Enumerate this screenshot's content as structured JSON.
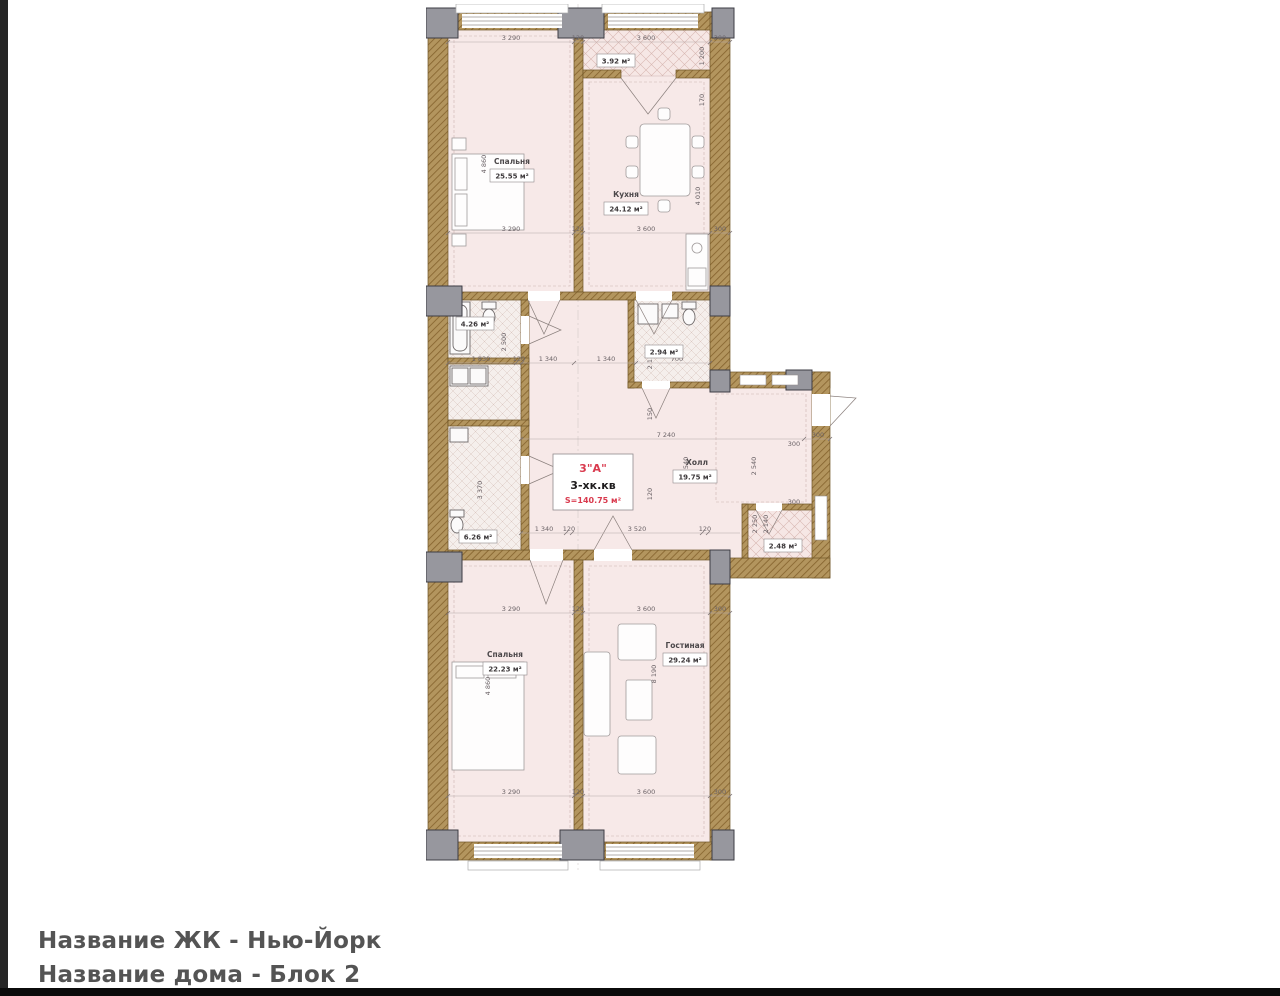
{
  "page": {
    "background": "#ffffff",
    "left_strip_color": "#262626",
    "bottom_strip_color": "#0b0b0b"
  },
  "footer": {
    "line1": "Название ЖК - Нью-Йорк",
    "line2": "Название дома - Блок 2"
  },
  "plan": {
    "apartment": {
      "number": "3\"А\"",
      "type": "3-хк.кв",
      "total_area": "S=140.75 м²"
    },
    "rooms": {
      "bedroom_top": {
        "name": "Спальня",
        "area": "25.55 м²"
      },
      "kitchen": {
        "name": "Кухня",
        "area": "24.12 м²"
      },
      "loggia_top": {
        "area": "3.92 м²"
      },
      "bathroom_1": {
        "area": "4.26 м²"
      },
      "wc": {
        "area": "2.94 м²"
      },
      "hall": {
        "name": "Холл",
        "area": "19.75 м²"
      },
      "bathroom_2": {
        "area": "6.26 м²"
      },
      "loggia_right": {
        "area": "2.48 м²"
      },
      "bedroom_bottom": {
        "name": "Спальня",
        "area": "22.23 м²"
      },
      "living_room": {
        "name": "Гостиная",
        "area": "29.24 м²"
      }
    },
    "dims": {
      "h_top": [
        "3 290",
        "120",
        "3 600",
        "300"
      ],
      "h_mid1": [
        "1 830",
        "120",
        "1 340",
        "1 340",
        "700"
      ],
      "h_hall": [
        "7 240",
        "300"
      ],
      "h_mid2": [
        "1 340",
        "120",
        "3 520",
        "120"
      ],
      "v": {
        "bedroom_top": "4 860",
        "loggia_top_depth": "1 200",
        "loggia_wall": "170",
        "kitchen": "4 010",
        "bathroom_1": "2 500",
        "wc": "2 110",
        "wc_small": "150",
        "hall_small": "120",
        "hall_left": "2 540",
        "hall_right": "2 540",
        "entry_top": "300",
        "entry_mid": "300",
        "bathroom_2": "3 370",
        "loggia_right_a": "2 250",
        "loggia_right_b": "2 140",
        "living_room": "8 190",
        "bedroom_bottom": "4 860"
      }
    },
    "colors": {
      "wall": "#b3955e",
      "column": "#97979e",
      "floor": "#f7e9e8",
      "accent_red": "#d93a4e"
    }
  }
}
